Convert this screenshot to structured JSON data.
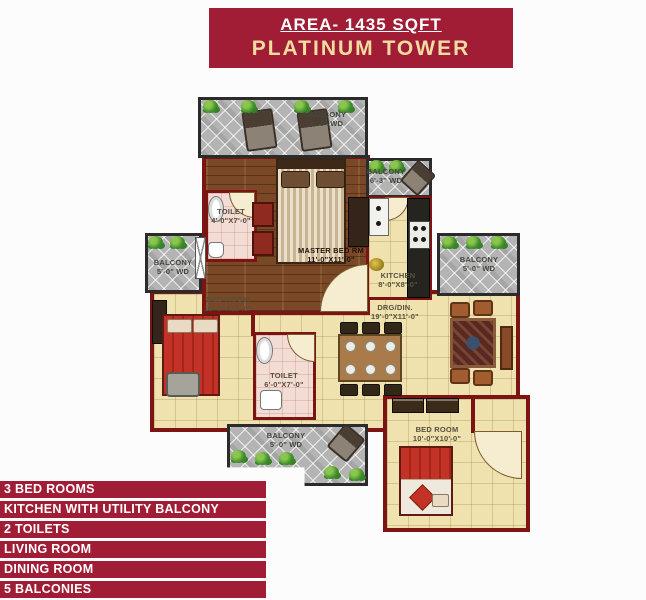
{
  "header": {
    "area_label": "AREA- 1435 SQFT",
    "tower_name": "PLATINUM TOWER",
    "bg_color": "#A01D35",
    "area_text_color": "#FFFFFF",
    "tower_text_color": "#F2DCA2"
  },
  "floor_plan": {
    "rooms": {
      "balcony_top": {
        "name": "BALCONY",
        "dim": "5'-0\" WD"
      },
      "master": {
        "name": "MASTER BED RM",
        "dim": "11'-0\"X11'-0\""
      },
      "toilet1": {
        "name": "TOILET",
        "dim": "4'-0\"X7'-0\""
      },
      "kitchen": {
        "name": "KITCHEN",
        "dim": "8'-0\"X8'-0\""
      },
      "balcony_utility": {
        "name": "BALCONY",
        "dim": "6'-3\" WD"
      },
      "balcony_right": {
        "name": "BALCONY",
        "dim": "5'-0\" WD"
      },
      "balcony_left": {
        "name": "BALCONY",
        "dim": "5'-0\" WD"
      },
      "bedroom_left": {
        "name": "BED ROOM",
        "dim": "10'-0\"X11'-0\""
      },
      "toilet2": {
        "name": "TOILET",
        "dim": "6'-0\"X7'-0\""
      },
      "living_dining": {
        "name": "DRG/DIN.",
        "dim": "19'-0\"X11'-0\""
      },
      "balcony_bottom": {
        "name": "BALCONY",
        "dim": "5'-0\" WD"
      },
      "bedroom_right": {
        "name": "BED ROOM",
        "dim": "10'-0\"X10'-0\""
      }
    },
    "colors": {
      "wall": "#7D1414",
      "floor_tile": "#EFE2AE",
      "wood_floor": "#7A4827",
      "balcony_tile": "#B4B4B4",
      "toilet_floor": "#F3DCD4"
    }
  },
  "features": {
    "items": [
      "3 BED ROOMS",
      "KITCHEN WITH UTILITY BALCONY",
      "2 TOILETS",
      "LIVING ROOM",
      "DINING ROOM",
      "5 BALCONIES"
    ],
    "bg_color": "#A01D35",
    "text_color": "#FFFFFF"
  }
}
